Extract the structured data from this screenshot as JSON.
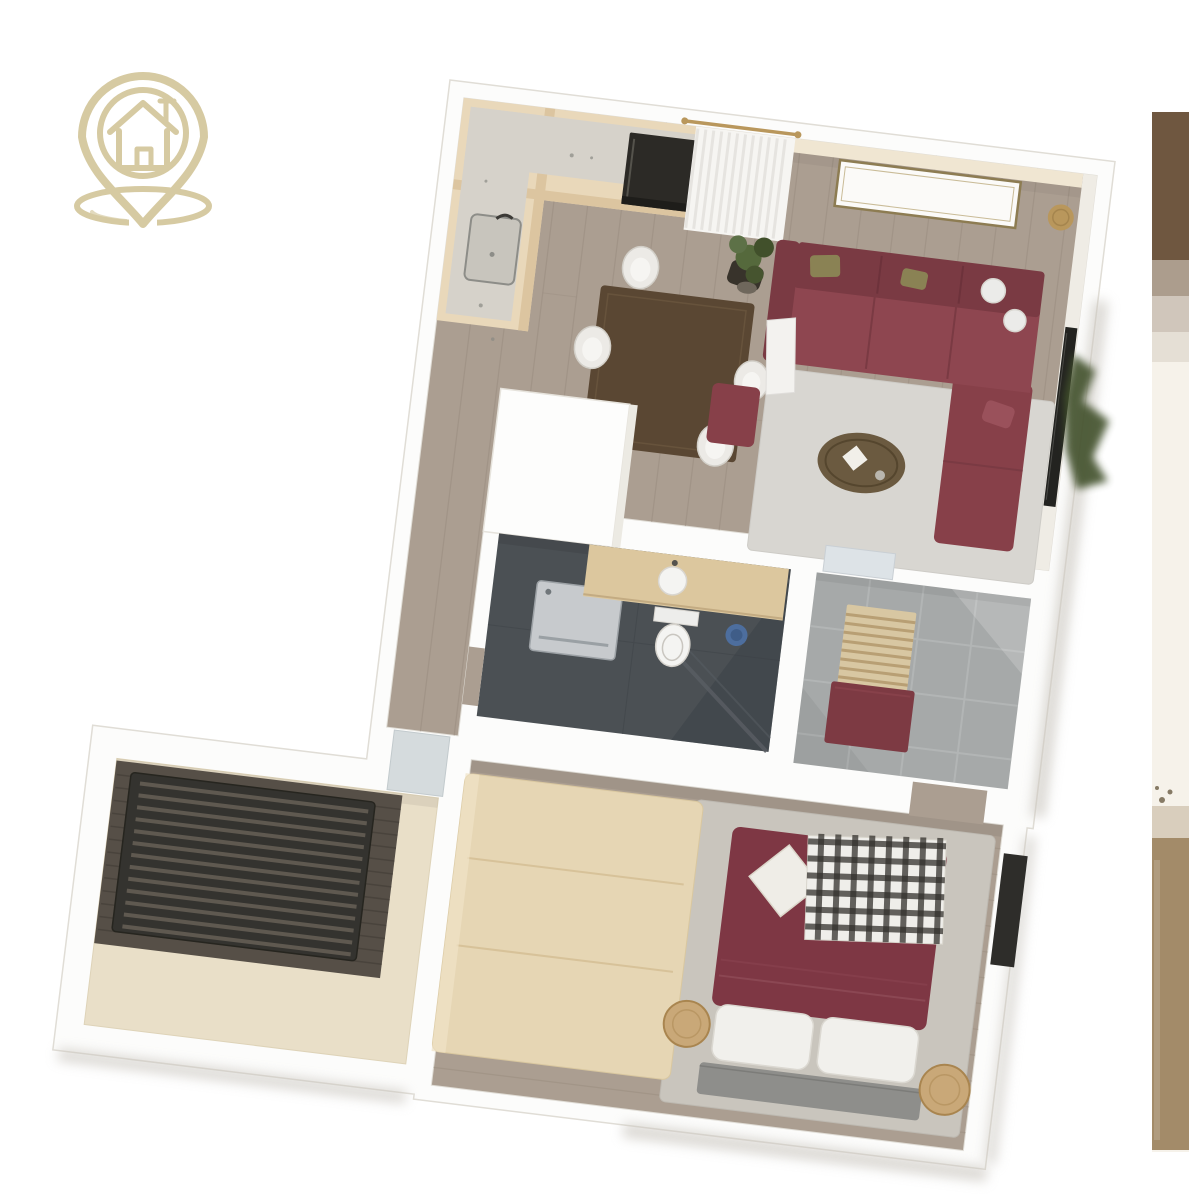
{
  "canvas": {
    "width": 1189,
    "height": 1200,
    "background": "#ffffff"
  },
  "brand": {
    "icon": "house-location-pin-icon",
    "color": "#d6caa2"
  },
  "floor_plan": {
    "kind": "3d-top-down-apartment-render",
    "rotation_deg": 7,
    "rooms": [
      "kitchen",
      "dining-area",
      "living-room",
      "hallway",
      "bathroom",
      "entry-hall",
      "bedroom",
      "balcony"
    ],
    "furniture": [
      "kitchen-counter",
      "oven",
      "sink",
      "dining-table",
      "dining-chairs",
      "white-cabinet",
      "corner-sofa",
      "ottoman",
      "coffee-table",
      "living-rug",
      "tv",
      "wall-art-frame",
      "curtain",
      "floor-plant",
      "gold-side-table",
      "washing-machine",
      "vanity",
      "toilet",
      "shower-screen",
      "blue-bucket",
      "entry-bench",
      "door-mat",
      "wardrobe",
      "double-bed",
      "plaid-throw",
      "pillows",
      "bedside-stools",
      "bedroom-rug",
      "balcony-daybed",
      "window-panel"
    ],
    "palette": {
      "bg": "#ffffff",
      "slab": "#fcfcfb",
      "wall_line": "#e0ddd6",
      "wood": "#ab9e91",
      "wood_line": "#978a7d",
      "rug": "#d8d6d1",
      "rug2": "#c9c5bd",
      "sofa": "#8e4650",
      "sofa_dark": "#7a3a43",
      "sofa_mid": "#874049",
      "cushion_olive": "#8a8254",
      "cushion_white": "#ebebe9",
      "coffee": "#6b5a40",
      "coffee_dark": "#55462e",
      "curtain": "#f6f5f2",
      "curtain_stripe": "#e6e4e0",
      "gold": "#b9975c",
      "frame": "#8d7c52",
      "plant": "#55693c",
      "plant_dark": "#41502b",
      "pot": "#6f675c",
      "counter": "#e9d8ba",
      "counter_face": "#dcc5a0",
      "worktop": "#d6d2ca",
      "appliance": "#2c2a26",
      "cabinet_white": "#fdfdfc",
      "table": "#5a4733",
      "chair": "#eceae6",
      "chair_dark": "#38332b",
      "bath_floor": "#4b5054",
      "shower_dark": "#3a3f45",
      "glass": "#585d63",
      "washer": "#c7cacd",
      "washer_line": "#9da2a6",
      "vanity": "#dcc79e",
      "porcelain": "#f4f4f2",
      "bucket": "#4d6e9e",
      "tile": "#a6a9a9",
      "tile_line": "#b8bbba",
      "mat": "#dde3e7",
      "bench_wood": "#d8c7a2",
      "bench_slat": "#b89f74",
      "bench_front": "#7d3a43",
      "bed": "#7e3744",
      "bed_fold": "#95515e",
      "plaid_light": "#efeeea",
      "plaid_dark": "#33302c",
      "pillow": "#f1f0ec",
      "headboard": "#8e8e8b",
      "stool": "#c9a878",
      "stool_dark": "#a9854f",
      "wardrobe": "#e6d6b4",
      "wardrobe_line": "#d3bd92",
      "deck": "#564f47",
      "deck_line": "#453e37",
      "daybed": "#34332f",
      "daybed_slat": "#5f5950",
      "terrace": "#e9dfc8",
      "tv": "#232320",
      "window_dark": "#2e2d2a",
      "strip_bg": "#f6f2ea",
      "strip_brown": "#6f5740",
      "strip_tan": "#a38b69"
    }
  },
  "side_photo": {
    "position": "partial-right-edge",
    "top_block_color": "#6f5740",
    "floor_color": "#a38b69"
  }
}
